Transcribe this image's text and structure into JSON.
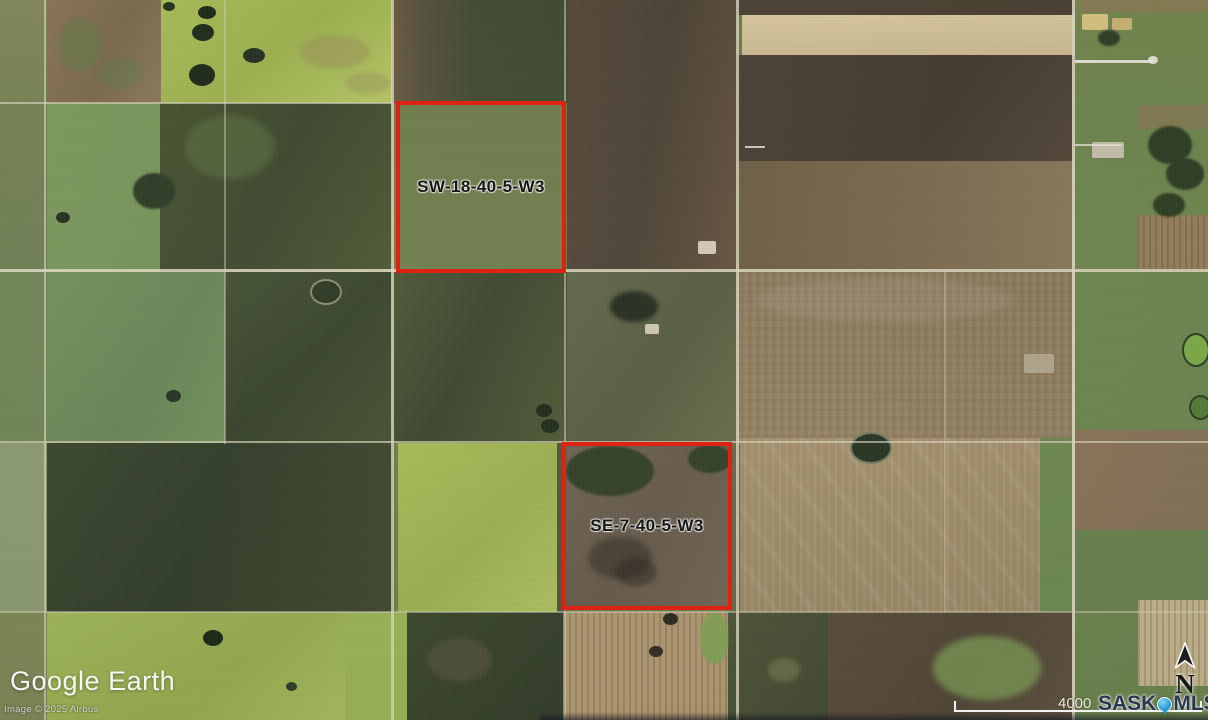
{
  "map": {
    "provider_logo": {
      "google": "Google",
      "earth": "Earth"
    },
    "attribution": "Image © 2025 Airbus",
    "parcels": [
      {
        "label": "SW-18-40-5-W3"
      },
      {
        "label": "SE-7-40-5-W3"
      }
    ],
    "scale_bar": {
      "value": "4000"
    },
    "branding": {
      "sask": "SASK",
      "mls": "MLS",
      "registered": "®"
    },
    "compass": {
      "label": "N"
    },
    "colors": {
      "parcel_outline": "#df2313",
      "brand_navy": "#2b3550",
      "brand_blue": "#2e9fd8"
    }
  }
}
